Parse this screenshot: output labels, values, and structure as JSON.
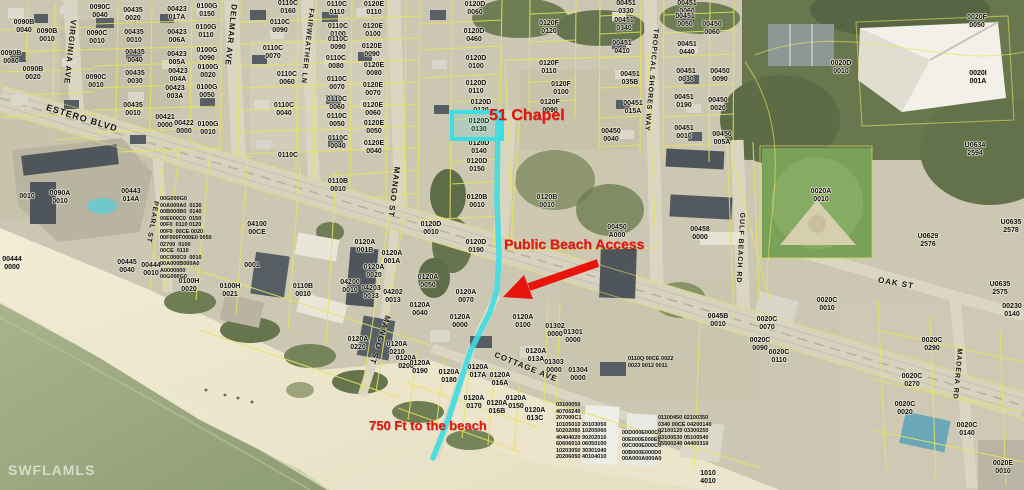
{
  "watermark": "SWFLAMLS",
  "highlighted_parcel": "0120D 0130",
  "colors": {
    "annotation": "#e8150d",
    "route_path": "#3ddde4",
    "parcel_line": "#e8e45c",
    "label_text": "#0d0d0d"
  },
  "annotations": [
    {
      "id": "chapel-address",
      "text": "51 Chapel",
      "x": 489,
      "y": 123,
      "size": 16
    },
    {
      "id": "public-beach-access",
      "text": "Public Beach Access",
      "x": 504,
      "y": 250,
      "size": 14
    },
    {
      "id": "distance-to-beach",
      "text": "750 Ft to the beach",
      "x": 369,
      "y": 431,
      "size": 13
    }
  ],
  "streets": [
    {
      "name": "ESTERO BLVD",
      "x": 82,
      "y": 118,
      "rot": 17,
      "size": 9
    },
    {
      "name": "VIRGINIA AVE",
      "x": 70,
      "y": 52,
      "rot": 96,
      "size": 8
    },
    {
      "name": "DELMAR AVE",
      "x": 231,
      "y": 35,
      "rot": 96,
      "size": 8
    },
    {
      "name": "FAIRWEATHER LN",
      "x": 307,
      "y": 46,
      "rot": 96,
      "size": 7
    },
    {
      "name": "MANGO ST",
      "x": 394,
      "y": 192,
      "rot": 97,
      "size": 8
    },
    {
      "name": "PEARL ST",
      "x": 152,
      "y": 222,
      "rot": 100,
      "size": 7
    },
    {
      "name": "MANGO ST",
      "x": 380,
      "y": 340,
      "rot": 108,
      "size": 8
    },
    {
      "name": "COTTAGE AVE",
      "x": 526,
      "y": 367,
      "rot": 22,
      "size": 8
    },
    {
      "name": "TROPICAL SHORES WAY",
      "x": 651,
      "y": 80,
      "rot": 95,
      "size": 7
    },
    {
      "name": "GULF BEACH RD",
      "x": 740,
      "y": 248,
      "rot": 93,
      "size": 7
    },
    {
      "name": "OAK ST",
      "x": 896,
      "y": 283,
      "rot": 10,
      "size": 8
    },
    {
      "name": "MADERA RD",
      "x": 957,
      "y": 374,
      "rot": 95,
      "size": 7
    }
  ],
  "parcels": [
    {
      "t": "0090B\n0040",
      "x": 24,
      "y": 27
    },
    {
      "t": "0090C\n0040",
      "x": 100,
      "y": 12
    },
    {
      "t": "0090B\n0010",
      "x": 47,
      "y": 36
    },
    {
      "t": "0090B\n0080",
      "x": 11,
      "y": 58
    },
    {
      "t": "0090B\n0020",
      "x": 33,
      "y": 74
    },
    {
      "t": "0090C\n0010",
      "x": 97,
      "y": 38
    },
    {
      "t": "0090C\n0010",
      "x": 96,
      "y": 82
    },
    {
      "t": "00435\n0020",
      "x": 133,
      "y": 15
    },
    {
      "t": "00435\n0010",
      "x": 134,
      "y": 37
    },
    {
      "t": "00435\n0040",
      "x": 135,
      "y": 57
    },
    {
      "t": "00435\n0030",
      "x": 135,
      "y": 78
    },
    {
      "t": "00435\n0010",
      "x": 133,
      "y": 110
    },
    {
      "t": "00423\n017A",
      "x": 177,
      "y": 14
    },
    {
      "t": "00423\n006A",
      "x": 177,
      "y": 37
    },
    {
      "t": "00423\n005A",
      "x": 177,
      "y": 59
    },
    {
      "t": "00423\n004A",
      "x": 178,
      "y": 76
    },
    {
      "t": "00423\n003A",
      "x": 175,
      "y": 93
    },
    {
      "t": "00421\n0000",
      "x": 165,
      "y": 122
    },
    {
      "t": "00422\n0000",
      "x": 184,
      "y": 128
    },
    {
      "t": "0100G\n0150",
      "x": 207,
      "y": 11
    },
    {
      "t": "0100G\n0110",
      "x": 206,
      "y": 32
    },
    {
      "t": "0100G\n0090",
      "x": 207,
      "y": 55
    },
    {
      "t": "0100G\n0020",
      "x": 208,
      "y": 72
    },
    {
      "t": "0100G\n0050",
      "x": 207,
      "y": 92
    },
    {
      "t": "0100G\n0010",
      "x": 208,
      "y": 129
    },
    {
      "t": "0110C\n0160",
      "x": 288,
      "y": 8
    },
    {
      "t": "0110C\n0090",
      "x": 280,
      "y": 27
    },
    {
      "t": "0110C\n0070",
      "x": 273,
      "y": 53
    },
    {
      "t": "0110C\n0060",
      "x": 287,
      "y": 79
    },
    {
      "t": "0110C\n0040",
      "x": 284,
      "y": 110
    },
    {
      "t": "0110C",
      "x": 288,
      "y": 156
    },
    {
      "t": "0110C\n0110",
      "x": 337,
      "y": 9
    },
    {
      "t": "0110C\n0100",
      "x": 338,
      "y": 31
    },
    {
      "t": "0110C\n0090",
      "x": 338,
      "y": 44
    },
    {
      "t": "0110C\n0080",
      "x": 336,
      "y": 63
    },
    {
      "t": "0110C\n0070",
      "x": 337,
      "y": 84
    },
    {
      "t": "0110C\n0060",
      "x": 337,
      "y": 104
    },
    {
      "t": "0110C\n0050",
      "x": 337,
      "y": 121
    },
    {
      "t": "0110C\n0040",
      "x": 338,
      "y": 143
    },
    {
      "t": "0120E\n0110",
      "x": 374,
      "y": 9
    },
    {
      "t": "0120E\n0100",
      "x": 373,
      "y": 31
    },
    {
      "t": "0120E\n0090",
      "x": 372,
      "y": 51
    },
    {
      "t": "0120E\n0080",
      "x": 374,
      "y": 70
    },
    {
      "t": "0120E\n0070",
      "x": 373,
      "y": 90
    },
    {
      "t": "0120E\n0060",
      "x": 373,
      "y": 110
    },
    {
      "t": "0120E\n0050",
      "x": 374,
      "y": 128
    },
    {
      "t": "0120E\n0040",
      "x": 374,
      "y": 148
    },
    {
      "t": "0120D\n0060",
      "x": 475,
      "y": 9
    },
    {
      "t": "0120D\n0460",
      "x": 474,
      "y": 36
    },
    {
      "t": "0120D\n0100",
      "x": 476,
      "y": 63
    },
    {
      "t": "0120D\n0110",
      "x": 476,
      "y": 88
    },
    {
      "t": "0120D\n0120",
      "x": 481,
      "y": 107
    },
    {
      "t": "0120D\n0130",
      "x": 479,
      "y": 126
    },
    {
      "t": "0120D\n0140",
      "x": 479,
      "y": 148
    },
    {
      "t": "0120D\n0150",
      "x": 477,
      "y": 166
    },
    {
      "t": "0120B\n0010",
      "x": 477,
      "y": 202
    },
    {
      "t": "0120B\n0010",
      "x": 547,
      "y": 202
    },
    {
      "t": "0120D\n0190",
      "x": 476,
      "y": 247
    },
    {
      "t": "0120D\n0010",
      "x": 431,
      "y": 229
    },
    {
      "t": "0120F\n0120",
      "x": 549,
      "y": 28
    },
    {
      "t": "0120F\n0110",
      "x": 549,
      "y": 68
    },
    {
      "t": "0120F\n0100",
      "x": 561,
      "y": 89
    },
    {
      "t": "0120F\n0090",
      "x": 550,
      "y": 107
    },
    {
      "t": "00451\n0330",
      "x": 626,
      "y": 8
    },
    {
      "t": "00451\n0340",
      "x": 624,
      "y": 25
    },
    {
      "t": "00451\n0410",
      "x": 622,
      "y": 48
    },
    {
      "t": "00451\n035B",
      "x": 630,
      "y": 79
    },
    {
      "t": "00451\n015A",
      "x": 633,
      "y": 108
    },
    {
      "t": "00450\n0040",
      "x": 611,
      "y": 136
    },
    {
      "t": "00451\n0060",
      "x": 687,
      "y": 8
    },
    {
      "t": "00451\n0050",
      "x": 685,
      "y": 21
    },
    {
      "t": "00451\n0440",
      "x": 687,
      "y": 49
    },
    {
      "t": "00451\n0030",
      "x": 686,
      "y": 76
    },
    {
      "t": "00451\n0190",
      "x": 684,
      "y": 102
    },
    {
      "t": "00451\n0010",
      "x": 684,
      "y": 133
    },
    {
      "t": "00450\n0060",
      "x": 712,
      "y": 29
    },
    {
      "t": "00450\n0090",
      "x": 720,
      "y": 76
    },
    {
      "t": "00450\n0020",
      "x": 718,
      "y": 105
    },
    {
      "t": "00450\n005A",
      "x": 722,
      "y": 139
    },
    {
      "t": "00450\nA000",
      "x": 617,
      "y": 232
    },
    {
      "t": "00458\n0000",
      "x": 700,
      "y": 234
    },
    {
      "t": "0020D\n0010",
      "x": 841,
      "y": 68
    },
    {
      "t": "0020F\n0050",
      "x": 977,
      "y": 22
    },
    {
      "t": "0020I\n001A",
      "x": 978,
      "y": 78
    },
    {
      "t": "U0634\n2594",
      "x": 975,
      "y": 150
    },
    {
      "t": "0020A\n0010",
      "x": 821,
      "y": 196
    },
    {
      "t": "U0629\n2576",
      "x": 928,
      "y": 241
    },
    {
      "t": "U0635\n2578",
      "x": 1011,
      "y": 227
    },
    {
      "t": "U0635\n2575",
      "x": 1000,
      "y": 289
    },
    {
      "t": "00230\n0140",
      "x": 1012,
      "y": 311
    },
    {
      "t": "0020C\n0010",
      "x": 827,
      "y": 305
    },
    {
      "t": "0045B\n0010",
      "x": 718,
      "y": 321
    },
    {
      "t": "01301\n0000",
      "x": 573,
      "y": 337
    },
    {
      "t": "01304\n0000",
      "x": 578,
      "y": 375
    },
    {
      "t": "0020C\n0070",
      "x": 767,
      "y": 324
    },
    {
      "t": "0020C\n0090",
      "x": 760,
      "y": 345
    },
    {
      "t": "0020C\n0110",
      "x": 779,
      "y": 357
    },
    {
      "t": "0020C\n0290",
      "x": 932,
      "y": 345
    },
    {
      "t": "0020C\n0270",
      "x": 912,
      "y": 381
    },
    {
      "t": "0020C\n0020",
      "x": 905,
      "y": 409
    },
    {
      "t": "0020C\n0140",
      "x": 967,
      "y": 430
    },
    {
      "t": "0020E\n0010",
      "x": 1003,
      "y": 468
    },
    {
      "t": "1010\n4010",
      "x": 708,
      "y": 478
    },
    {
      "t": "0120A\n0050",
      "x": 428,
      "y": 282
    },
    {
      "t": "0120A\n0070",
      "x": 466,
      "y": 297
    },
    {
      "t": "0120A\n0040",
      "x": 420,
      "y": 310
    },
    {
      "t": "0120A\n0000",
      "x": 460,
      "y": 322
    },
    {
      "t": "0120A\n0100",
      "x": 523,
      "y": 322
    },
    {
      "t": "01302\n0000",
      "x": 555,
      "y": 331
    },
    {
      "t": "0120A\n013A",
      "x": 536,
      "y": 356
    },
    {
      "t": "01303\n0000",
      "x": 554,
      "y": 367
    },
    {
      "t": "0120A\n001B",
      "x": 365,
      "y": 247
    },
    {
      "t": "0120A\n001A",
      "x": 392,
      "y": 258
    },
    {
      "t": "0120A\n0020",
      "x": 374,
      "y": 272
    },
    {
      "t": "04200\n0010",
      "x": 350,
      "y": 287
    },
    {
      "t": "04203\n0033",
      "x": 371,
      "y": 293
    },
    {
      "t": "04202\n0013",
      "x": 393,
      "y": 297
    },
    {
      "t": "0120A\n0220",
      "x": 358,
      "y": 344
    },
    {
      "t": "0120A\n0210",
      "x": 397,
      "y": 349
    },
    {
      "t": "0120A\n0200",
      "x": 406,
      "y": 363
    },
    {
      "t": "0120A\n0190",
      "x": 420,
      "y": 368
    },
    {
      "t": "0120A\n0180",
      "x": 449,
      "y": 377
    },
    {
      "t": "0120A\n017A",
      "x": 478,
      "y": 372
    },
    {
      "t": "0120A\n016A",
      "x": 500,
      "y": 380
    },
    {
      "t": "0120A\n0170",
      "x": 474,
      "y": 403
    },
    {
      "t": "0120A\n016B",
      "x": 497,
      "y": 408
    },
    {
      "t": "0120A\n0150",
      "x": 516,
      "y": 403
    },
    {
      "t": "0120A\n013C",
      "x": 535,
      "y": 415
    },
    {
      "t": "04100\n00CE",
      "x": 257,
      "y": 229
    },
    {
      "t": "0001",
      "x": 252,
      "y": 266
    },
    {
      "t": "0100H\n0020",
      "x": 189,
      "y": 286
    },
    {
      "t": "0100H\n0021",
      "x": 230,
      "y": 291
    },
    {
      "t": "0110B\n0010",
      "x": 338,
      "y": 186
    },
    {
      "t": "0110B\n0010",
      "x": 303,
      "y": 291
    },
    {
      "t": "0010",
      "x": 27,
      "y": 197
    },
    {
      "t": "0090A\n0010",
      "x": 60,
      "y": 198
    },
    {
      "t": "00443\n014A",
      "x": 131,
      "y": 196
    },
    {
      "t": "00445\n0040",
      "x": 127,
      "y": 267
    },
    {
      "t": "00444\n0010",
      "x": 151,
      "y": 270
    },
    {
      "t": "00444\n0000",
      "x": 12,
      "y": 264
    }
  ],
  "clusters": [
    {
      "id": "pearl-st-condos",
      "x": 160,
      "y": 196,
      "rows": [
        "00G000G0",
        "00A000A0  0130",
        "00B000B0  0140",
        "00E000C0  0150",
        "00F0  0110 0120",
        "00F0  00CE 0020",
        "00F000F000E0 0050",
        "02700  0100",
        "00CE  0110",
        "00C000C0  0010",
        "00A000B000A0",
        "A0000000",
        "00G000G0"
      ]
    },
    {
      "id": "estero-condos-left",
      "x": 556,
      "y": 402,
      "rows": [
        "03100050",
        "40700240",
        "207000C1",
        "10105010 20103050",
        "50202060 10205060",
        "40404020 90202010",
        "60606010 06050100",
        "10203050 30301040",
        "20206050 40104010"
      ]
    },
    {
      "id": "estero-condos-center",
      "x": 622,
      "y": 430,
      "rows": [
        "00D000E000C0",
        "00E000E000E0",
        "00C000E000C0",
        "00B000E000D0",
        "00A000A000A0"
      ]
    },
    {
      "id": "estero-condos-right",
      "x": 658,
      "y": 415,
      "rows": [
        "01100450 02100350",
        "0340 00CE 04200140",
        "02100120 03300250",
        "03100530 05100540",
        "05500240 04400310"
      ]
    },
    {
      "id": "oak-corner-units",
      "x": 628,
      "y": 356,
      "rows": [
        "0110Q 00CE 0022",
        "0023 0012 0011"
      ]
    }
  ]
}
